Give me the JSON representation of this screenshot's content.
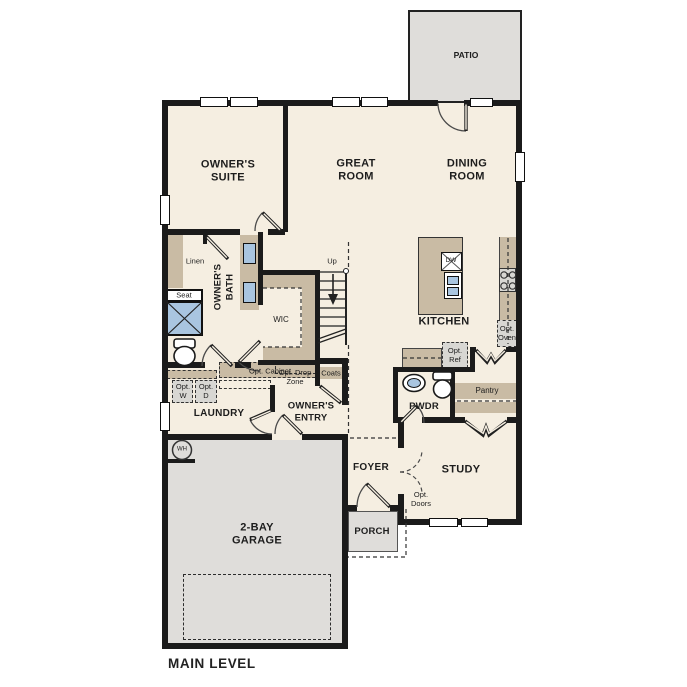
{
  "title": "MAIN LEVEL",
  "colors": {
    "wall": "#1b1b1b",
    "floor": "#f5eee1",
    "cabinet": "#c9bba4",
    "exterior": "#dfddda",
    "fixture_blue": "#a9c5e0",
    "option_gray": "#d8d7d3"
  },
  "labels": {
    "patio": "PATIO",
    "owners_suite": "OWNER'S\nSUITE",
    "great_room": "GREAT\nROOM",
    "dining_room": "DINING\nROOM",
    "kitchen": "KITCHEN",
    "owners_bath": "OWNER'S\nBATH",
    "wic": "WIC",
    "linen": "Linen",
    "seat": "Seat",
    "up": "Up",
    "coats": "Coats",
    "opt_cabinet": "Opt. Cabinet",
    "opt_drop_zone": "Opt. Drop\nZone",
    "opt_w": "Opt.\nW",
    "opt_d": "Opt.\nD",
    "laundry": "LAUNDRY",
    "owners_entry": "OWNER'S\nENTRY",
    "opt_ref": "Opt.\nRef",
    "opt_oven": "Opt.\nOven",
    "dw": "DW",
    "pantry": "Pantry",
    "pwdr": "PWDR",
    "foyer": "FOYER",
    "study": "STUDY",
    "opt_doors": "Opt.\nDoors",
    "porch": "PORCH",
    "garage": "2-BAY\nGARAGE",
    "wh": "WH",
    "main_level": "MAIN LEVEL"
  }
}
